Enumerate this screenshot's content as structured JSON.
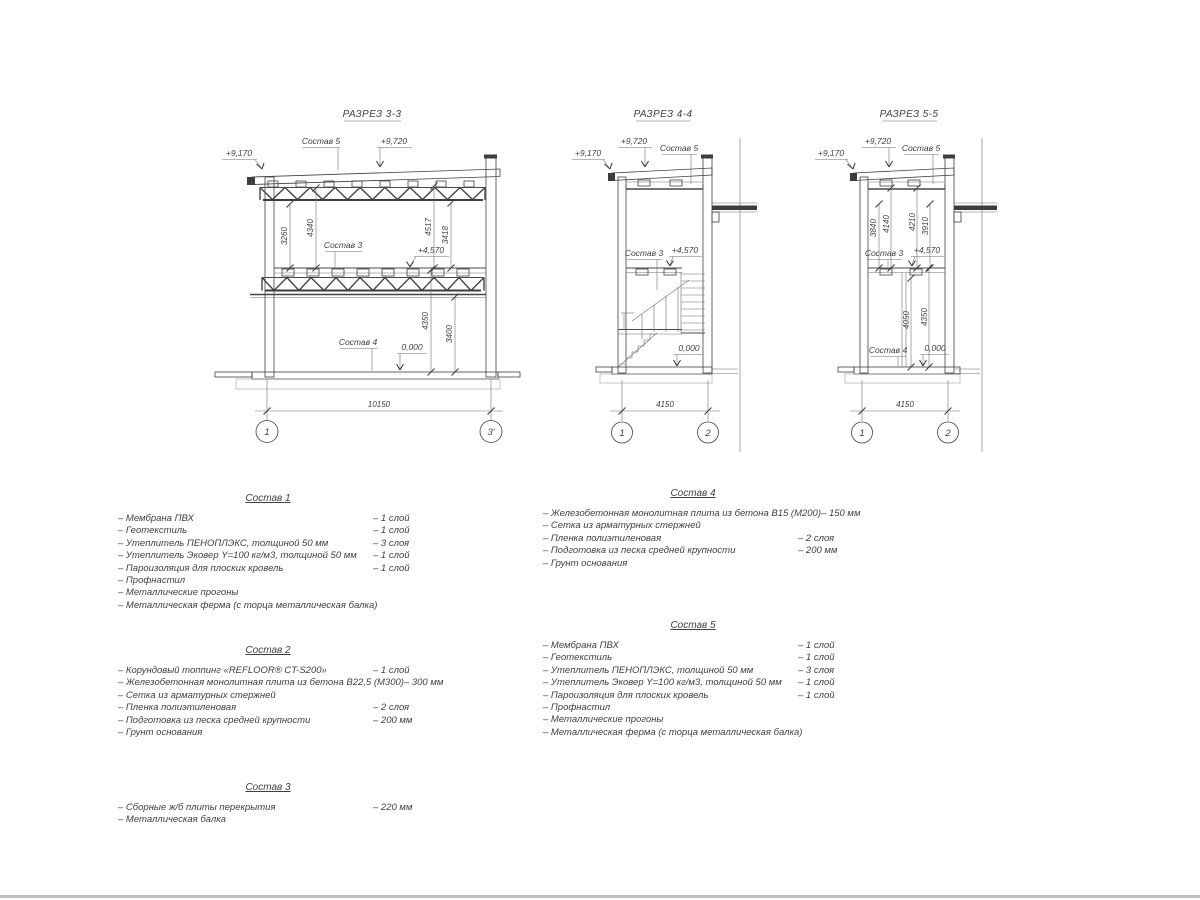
{
  "sections": {
    "s33": {
      "title": "РАЗРЕЗ 3-3",
      "comp5_label": "Состав 5",
      "comp3_label": "Состав 3",
      "comp4_label": "Состав 4",
      "lvl_eave": "+9,170",
      "lvl_roof": "+9,720",
      "lvl_mid": "+4,570",
      "lvl_zero": "0,000",
      "dim_u1": "3260",
      "dim_u2": "4340",
      "dim_u3": "4517",
      "dim_u4": "3418",
      "dim_l1": "4350",
      "dim_l2": "3400",
      "span": "10150",
      "axis_l": "1",
      "axis_r": "3'"
    },
    "s44": {
      "title": "РАЗРЕЗ 4-4",
      "comp5_label": "Состав 5",
      "comp3_label": "Состав 3",
      "lvl_eave": "+9,170",
      "lvl_roof": "+9,720",
      "lvl_mid": "+4,570",
      "lvl_zero": "0,000",
      "span": "4150",
      "axis_l": "1",
      "axis_r": "2"
    },
    "s55": {
      "title": "РАЗРЕЗ 5-5",
      "comp5_label": "Состав 5",
      "comp3_label": "Состав 3",
      "comp4_label": "Состав 4",
      "lvl_eave": "+9,170",
      "lvl_roof": "+9,720",
      "lvl_mid": "+4,570",
      "lvl_zero": "0,000",
      "dim_u1": "3840",
      "dim_u2": "4140",
      "dim_u3": "4210",
      "dim_u4": "3910",
      "dim_l1": "4050",
      "dim_l2": "4350",
      "span": "4150",
      "axis_l": "1",
      "axis_r": "2"
    }
  },
  "compositions": [
    {
      "title": "Состав 1",
      "items": [
        {
          "t": "– Мембрана ПВХ",
          "v": "– 1 слой"
        },
        {
          "t": "– Геотекстиль",
          "v": "– 1 слой"
        },
        {
          "t": "– Утеплитель ПЕНОПЛЭКС, толщиной 50 мм",
          "v": "– 3 слоя"
        },
        {
          "t": "– Утеплитель Эковер Y=100 кг/м3, толщиной 50 мм",
          "v": "– 1 слой"
        },
        {
          "t": "– Пароизоляция для плоских кровель",
          "v": "– 1 слой"
        },
        {
          "t": "– Профнастил",
          "v": ""
        },
        {
          "t": "– Металлические прогоны",
          "v": ""
        },
        {
          "t": "– Металлическая ферма (с торца металлическая балка)",
          "v": ""
        }
      ]
    },
    {
      "title": "Состав 2",
      "items": [
        {
          "t": "– Корундовый топпинг «REFLOOR® CT-S200»",
          "v": "– 1 слой"
        },
        {
          "t": "– Железобетонная  монолитная плита из бетона В22,5 (М300)",
          "v": "– 300 мм"
        },
        {
          "t": "– Сетка из арматурных стержней",
          "v": ""
        },
        {
          "t": "– Пленка полиэтиленовая",
          "v": "– 2 слоя"
        },
        {
          "t": "– Подготовка из песка средней крупности",
          "v": "– 200 мм"
        },
        {
          "t": "– Грунт основания",
          "v": ""
        }
      ]
    },
    {
      "title": "Состав 3",
      "items": [
        {
          "t": "– Сборные ж/б плиты перекрытия",
          "v": "– 220 мм"
        },
        {
          "t": "– Металлическая балка",
          "v": ""
        }
      ]
    },
    {
      "title": "Состав 4",
      "items": [
        {
          "t": "– Железобетонная  монолитная плита из бетона В15 (М200)",
          "v": "– 150 мм"
        },
        {
          "t": "– Сетка из арматурных стержней",
          "v": ""
        },
        {
          "t": "– Пленка полиэтиленовая",
          "v": "– 2 слоя"
        },
        {
          "t": "– Подготовка из песка средней крупности",
          "v": "– 200 мм"
        },
        {
          "t": "– Грунт основания",
          "v": ""
        }
      ]
    },
    {
      "title": "Состав 5",
      "items": [
        {
          "t": "– Мембрана ПВХ",
          "v": "– 1 слой"
        },
        {
          "t": "– Геотекстиль",
          "v": "– 1 слой"
        },
        {
          "t": "– Утеплитель ПЕНОПЛЭКС, толщиной 50 мм",
          "v": "– 3 слоя"
        },
        {
          "t": "– Утеплитель Эковер Y=100 кг/м3, толщиной 50 мм",
          "v": "– 1 слой"
        },
        {
          "t": "– Пароизоляция для плоских кровель",
          "v": "– 1 слой"
        },
        {
          "t": "– Профнастил",
          "v": ""
        },
        {
          "t": "– Металлические прогоны",
          "v": ""
        },
        {
          "t": "– Металлическая ферма (с торца металлическая балка)",
          "v": ""
        }
      ]
    }
  ]
}
